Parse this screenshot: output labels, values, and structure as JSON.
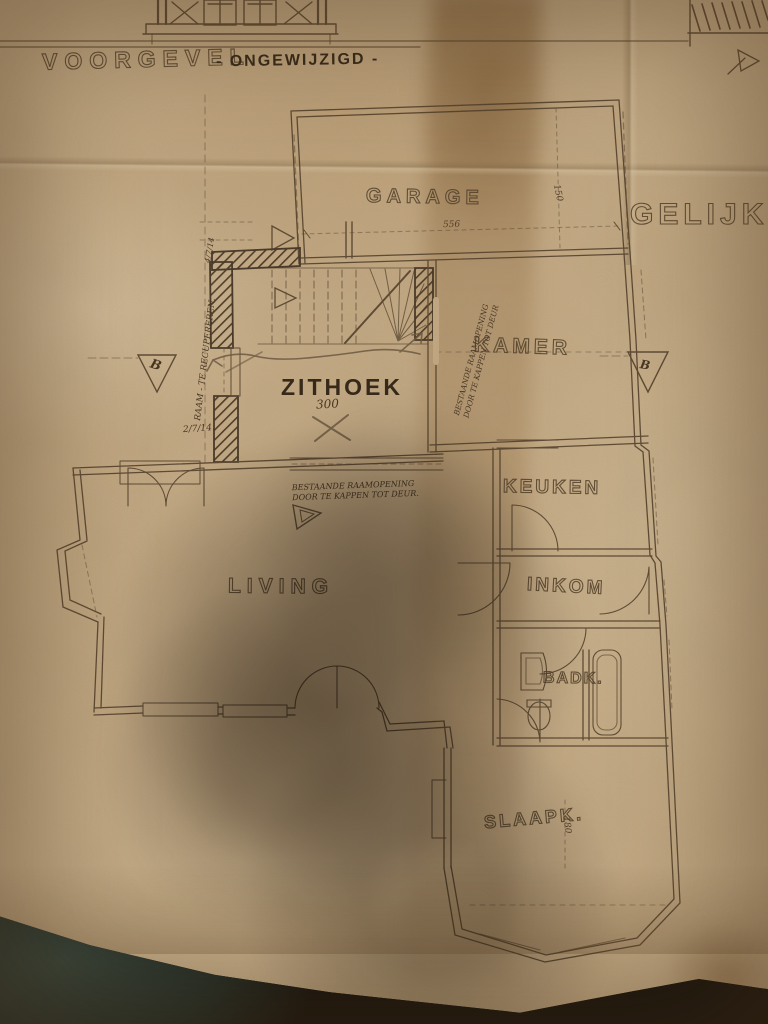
{
  "titles": {
    "elevation": "VOORGEVEL",
    "elevation_status": "- ONGEWIJZIGD -",
    "plan_partial": "GELIJKV"
  },
  "rooms": {
    "garage": "GARAGE",
    "kamer": "KAMER",
    "zithoek": "ZITHOEK",
    "keuken": "KEUKEN",
    "inkom": "INKOM",
    "badkamer": "BADK.",
    "slaapkamer": "SLAAPK.",
    "living": "LIVING"
  },
  "notes": {
    "zithoek_size": "300",
    "window_reuse": "RAAM - TE RECUPEREREN.",
    "date_top": "4/7/14",
    "date_bottom": "2/7/14.",
    "opening_v_line1": "BESTAANDE RAAMOPENING",
    "opening_v_line2": "DOOR TE KAPPEN TOT DEUR",
    "opening_h_line1": "BESTAANDE RAAMOPENING",
    "opening_h_line2": "DOOR TE KAPPEN TOT DEUR."
  },
  "dimensions": {
    "garage_width": "556",
    "garage_depth": "150",
    "slaapk_depth": "180"
  },
  "markers": {
    "section_left": "B",
    "section_right": "B"
  }
}
